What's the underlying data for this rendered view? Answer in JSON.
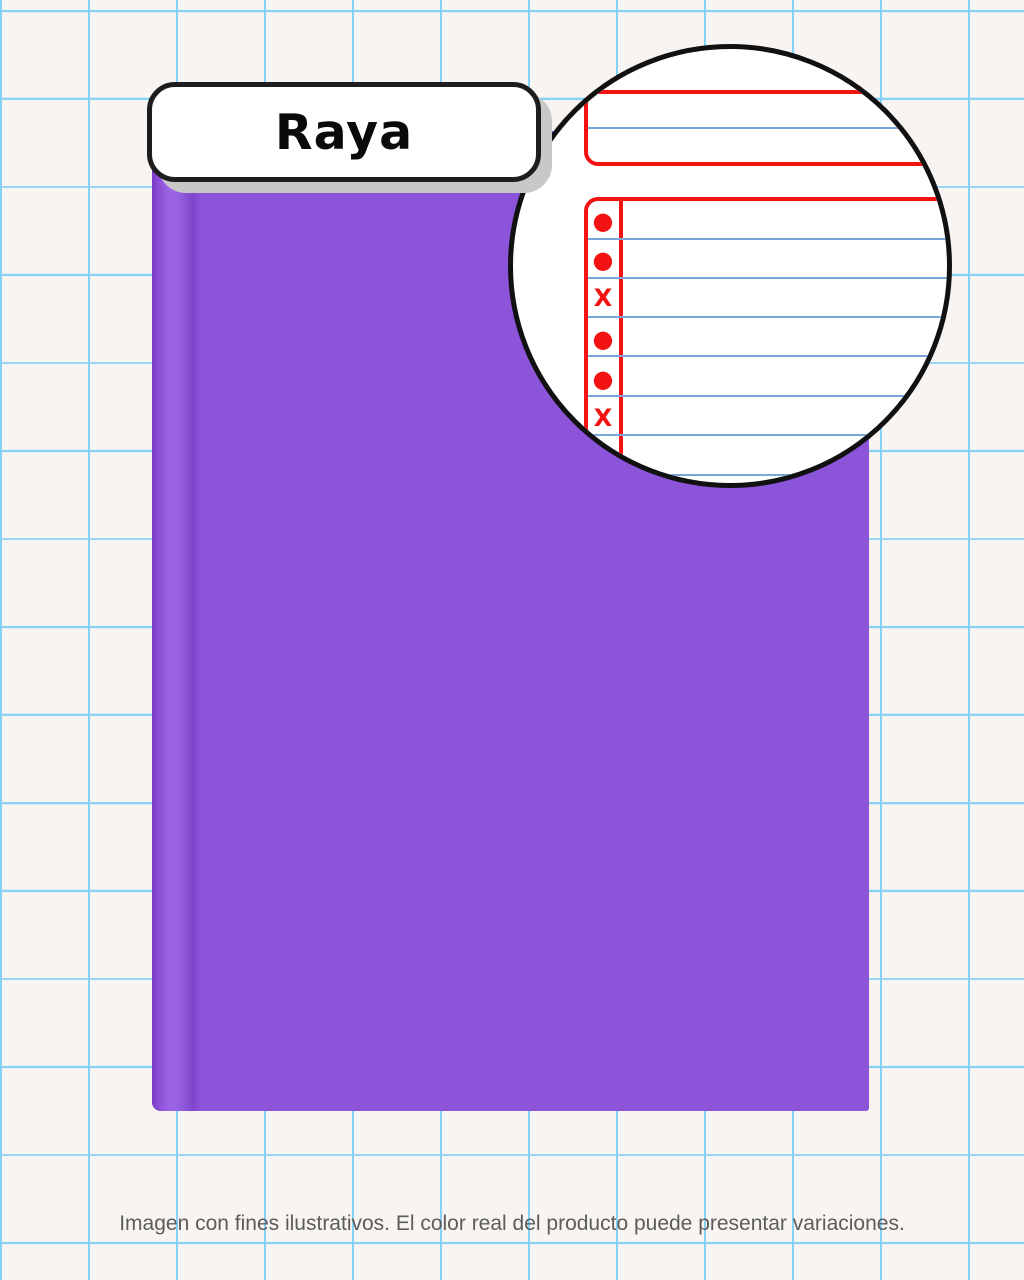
{
  "label": {
    "text": "Raya"
  },
  "notebook": {
    "cover_color": "#8c54d9",
    "item": "notebook-cover"
  },
  "magnifier": {
    "marks": [
      "●",
      "●",
      "X",
      "●",
      "●",
      "X"
    ],
    "accent_red": "#f41313",
    "rule_blue": "#78a6db"
  },
  "background": {
    "grid_color": "#84d2f8",
    "paper_color": "#f7f4f1"
  },
  "caption": {
    "text": "Imagen con fines ilustrativos. El color real del producto puede presentar variaciones."
  }
}
